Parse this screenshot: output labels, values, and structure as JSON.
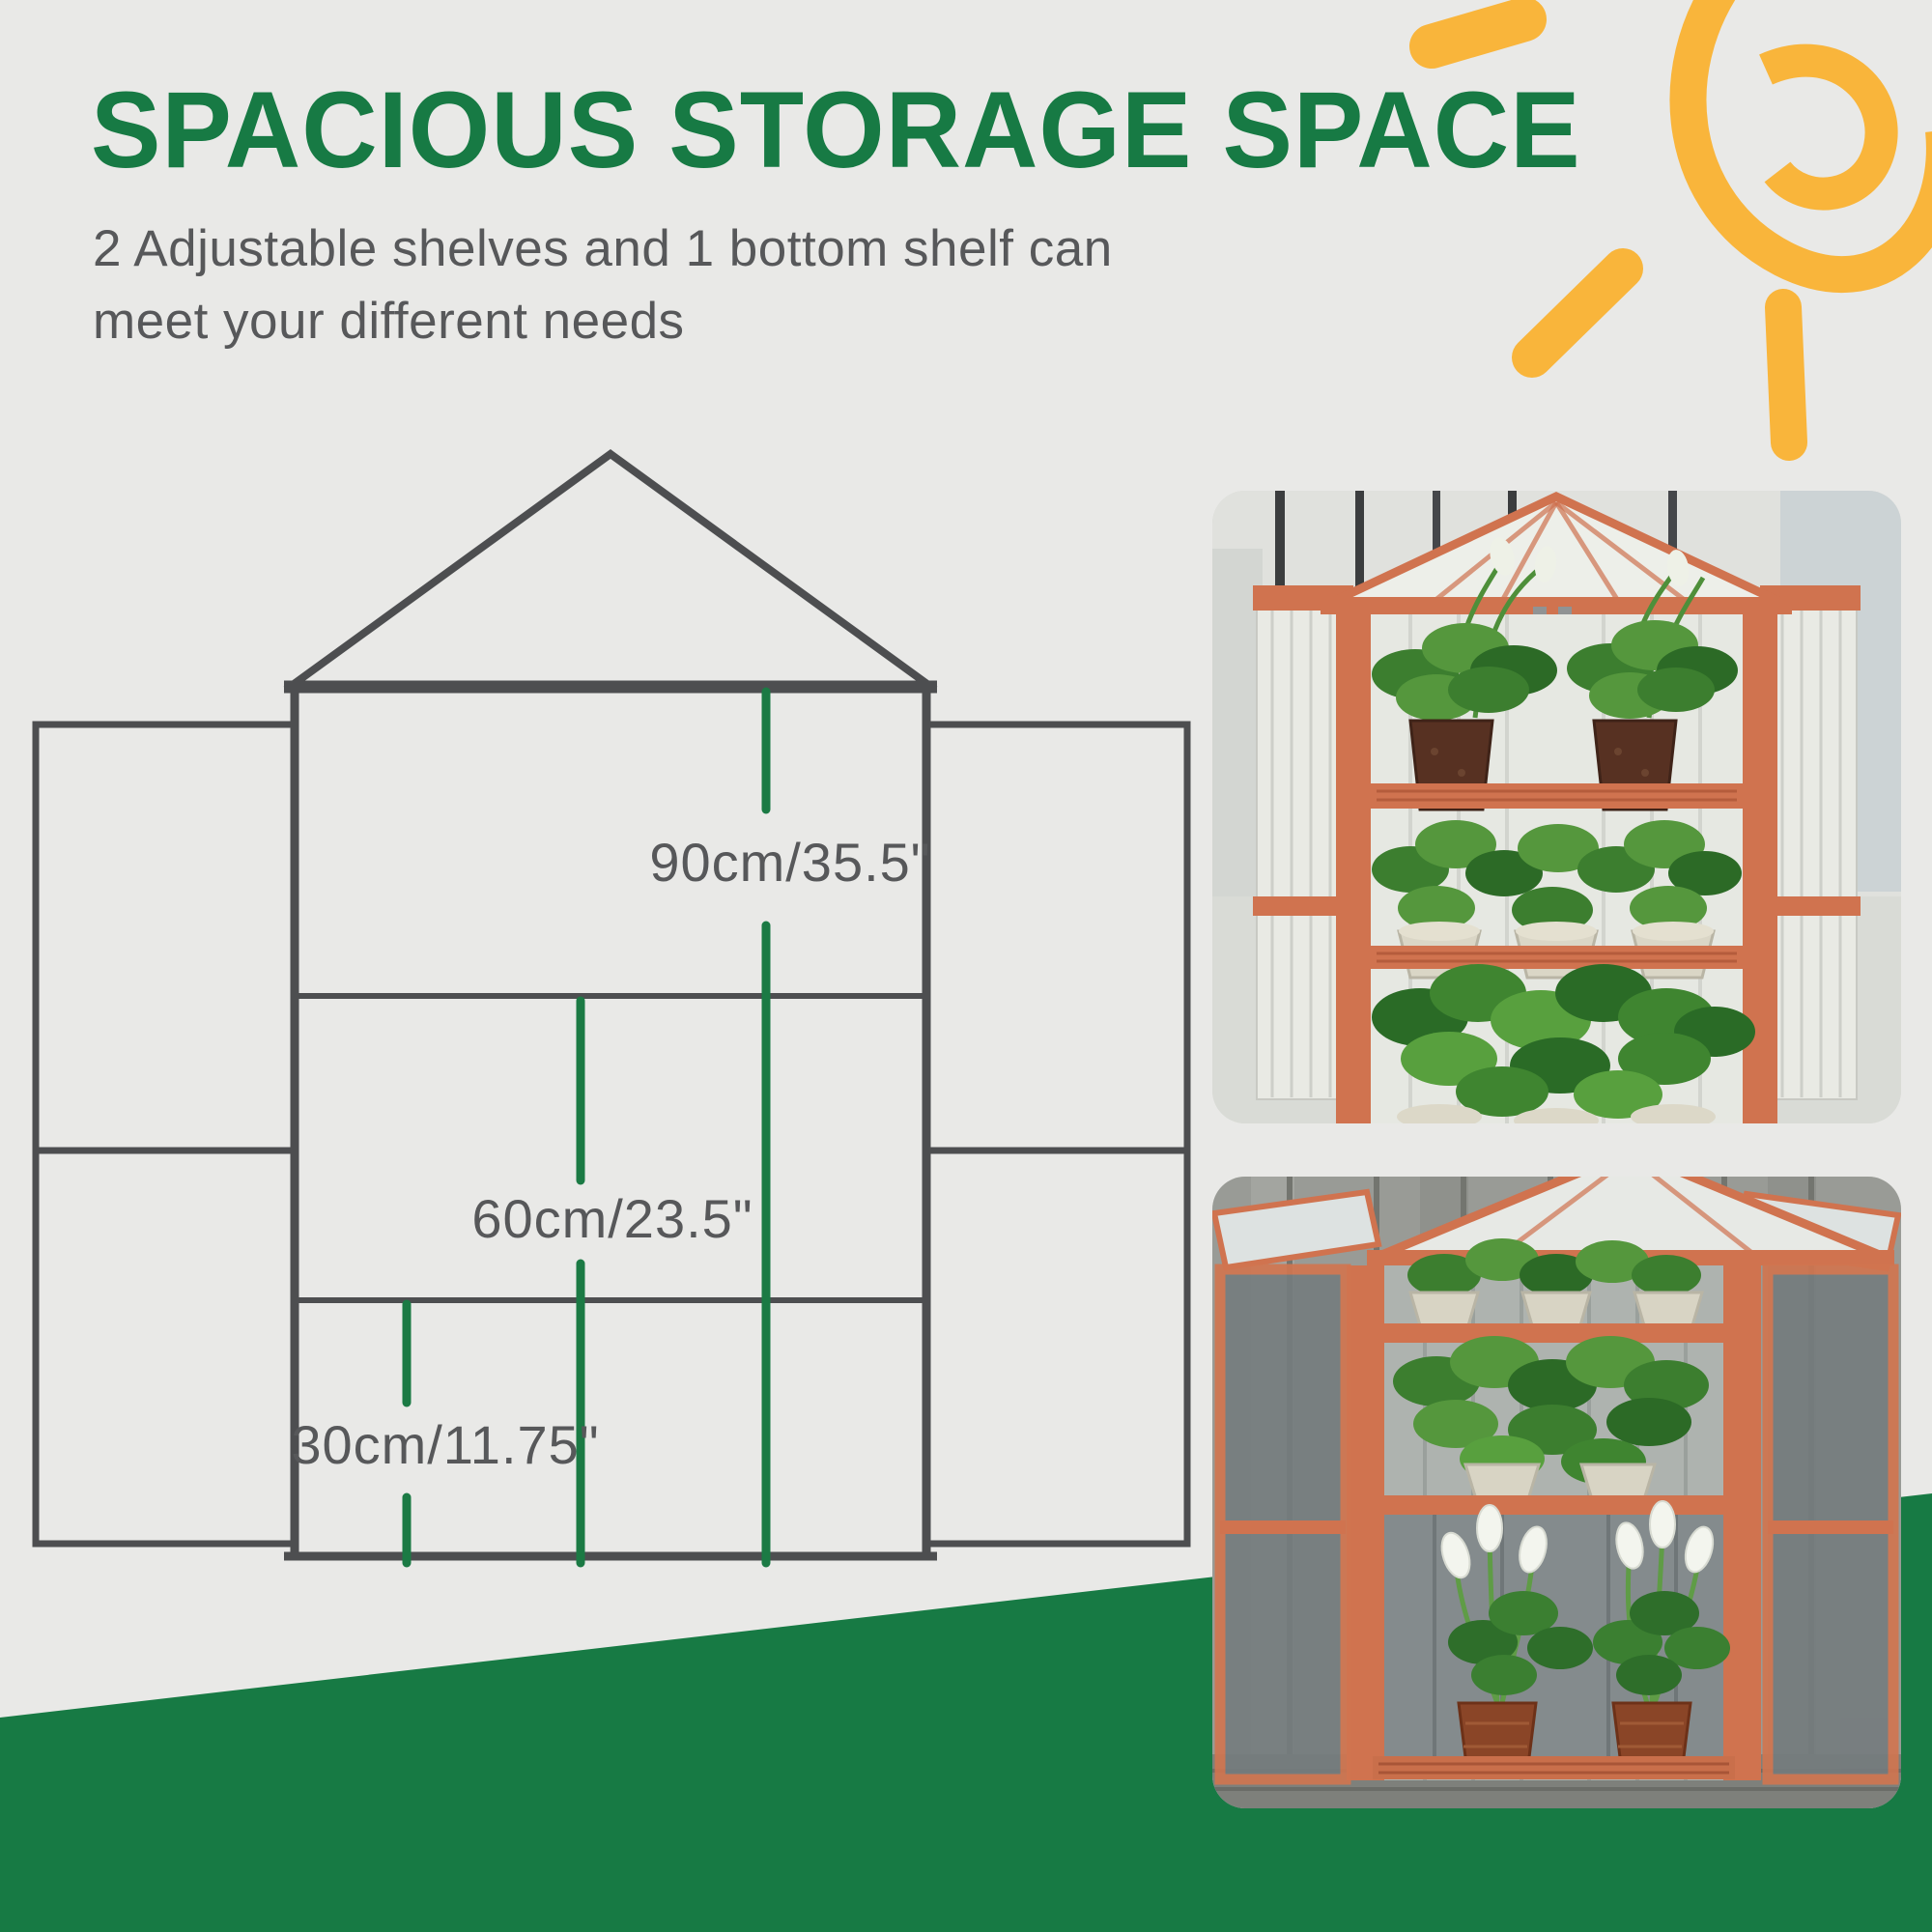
{
  "header": {
    "title": "SPACIOUS STORAGE SPACE",
    "subtitle_lines": [
      "2 Adjustable shelves and 1 bottom shelf can",
      "meet your different needs"
    ]
  },
  "diagram": {
    "labels": {
      "height_total": "90cm/35.5\"",
      "height_middle": "60cm/23.5\"",
      "height_bottom": "30cm/11.75\""
    }
  },
  "colors": {
    "brand_green": "#177a44",
    "dimension_green": "#1b7a44",
    "sun_yellow": "#f9b53b",
    "line_gray": "#4d4e50",
    "text_gray": "#57585a",
    "wood_orange": "#d0734f",
    "bg": "#e9e9e7"
  }
}
